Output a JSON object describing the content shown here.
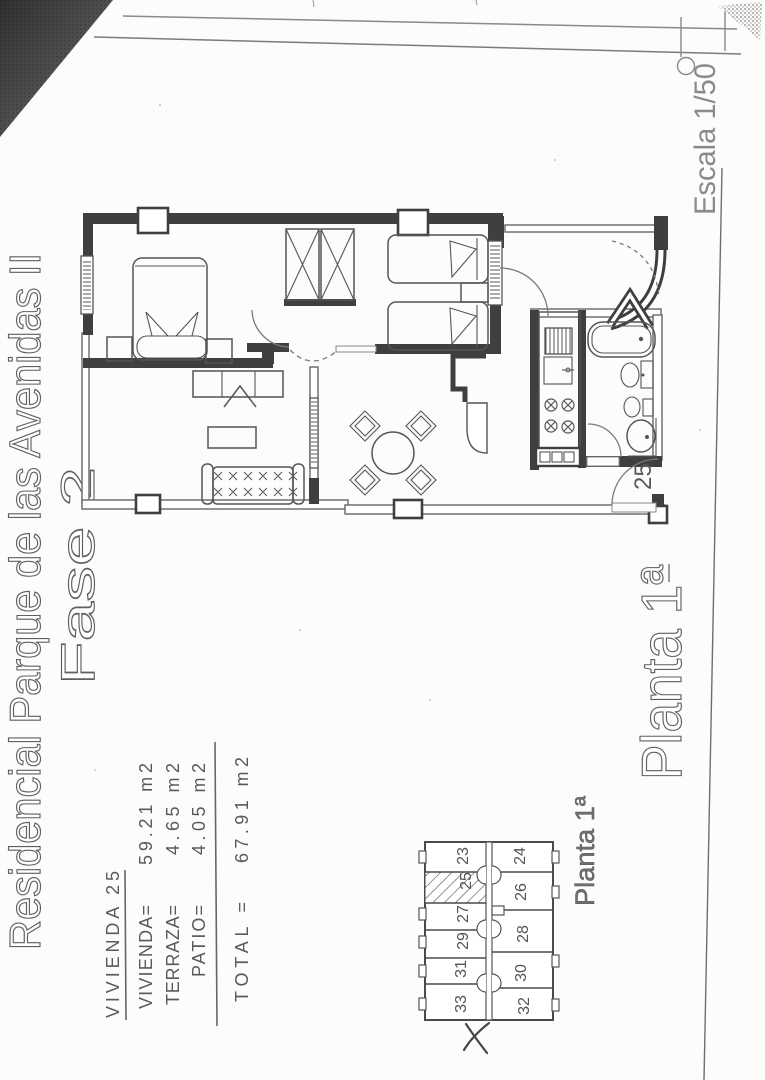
{
  "sheet": {
    "title": "Residencial Parque de las Avenidas II",
    "phase": "Fase 2",
    "scale_label": "Escala 1/50",
    "floor_label_large": "Planta 1ª",
    "floor_label_small": "Planta 1ª",
    "area_table": {
      "header": "VIVIENDA 25",
      "rows": [
        {
          "label": "VIVIENDA=",
          "value": "59.21 m2"
        },
        {
          "label": "TERRAZA=",
          "value": "4.65 m2"
        },
        {
          "label": "PATIO=",
          "value": "4.05 m2"
        }
      ],
      "total": {
        "label": "TOTAL  =",
        "value": "67.91 m2"
      }
    },
    "floor_plan": {
      "unit_number": "25"
    },
    "key_plan": {
      "highlighted_unit": "25",
      "row_a_units": [
        "23",
        "25",
        "27",
        "29",
        "31",
        "33"
      ],
      "row_b_units": [
        "24",
        "26",
        "28",
        "30",
        "32"
      ]
    },
    "colors": {
      "ink": "#3f3f3f",
      "text": "#5a5a5a",
      "paper": "#fcfcfb"
    }
  }
}
